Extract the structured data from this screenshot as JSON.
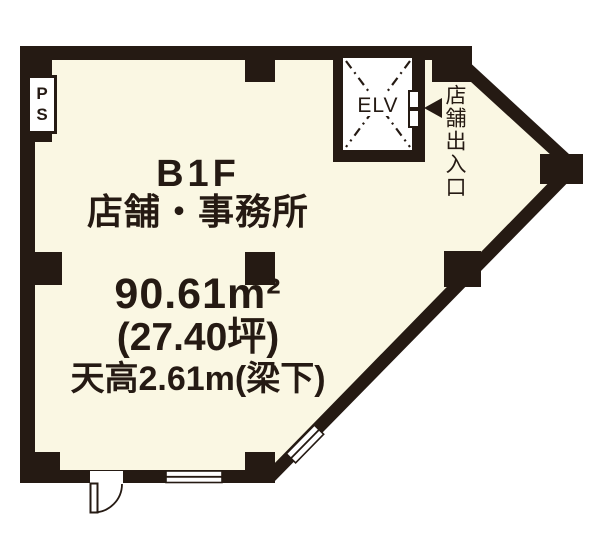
{
  "colors": {
    "wall": "#251a13",
    "floor": "#faf7e3",
    "text": "#251a13",
    "paper": "#ffffff"
  },
  "plan": {
    "floor_label": "B1F",
    "use_label": "店舗・事務所",
    "area_sqm": "90.61m²",
    "area_tsubo": "(27.40坪)",
    "ceiling_height": "天高2.61m(梁下)",
    "ps_label": "PS",
    "elevator_label": "ELV",
    "entrance_label": "店舗出入口"
  },
  "values": {
    "area_sqm_value": "90.61",
    "area_tsubo_value": "27.40",
    "ceiling_height_m": "2.61"
  }
}
